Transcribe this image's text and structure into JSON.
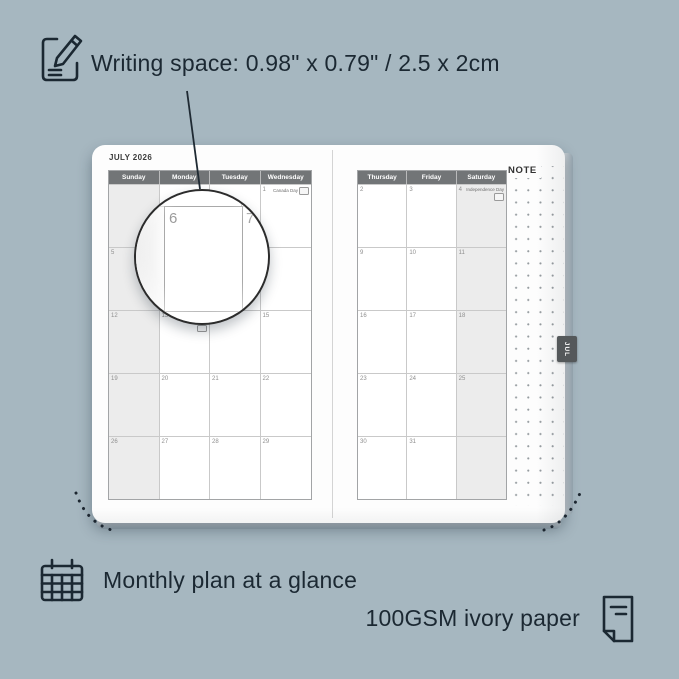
{
  "colors": {
    "background": "#a6b7c0",
    "annotation_text": "#1b2832",
    "calendar_header_bg": "#727577",
    "shaded_column_bg": "#ececec",
    "month_tab_bg": "#54585a",
    "page_bg": "#fdfdfd"
  },
  "annotations": {
    "writing_space": "Writing space: 0.98\" x 0.79\" / 2.5 x 2cm",
    "monthly_plan": "Monthly plan at a glance",
    "paper": "100GSM ivory paper"
  },
  "planner": {
    "month_title": "JULY 2026",
    "tab_label": "JUL",
    "note_label": "NOTE",
    "left_page": {
      "day_headers": [
        "Sunday",
        "Monday",
        "Tuesday",
        "Wednesday"
      ],
      "shaded_column": 0,
      "weeks": [
        [
          {
            "date": ""
          },
          {
            "date": ""
          },
          {
            "date": ""
          },
          {
            "date": "1",
            "holiday": "Canada Day",
            "badge": true
          }
        ],
        [
          {
            "date": "5"
          },
          {
            "date": "6"
          },
          {
            "date": "7"
          },
          {
            "date": "8"
          }
        ],
        [
          {
            "date": "12"
          },
          {
            "date": "13",
            "holiday": "Battle of the Boyne",
            "badge": true
          },
          {
            "date": "14"
          },
          {
            "date": "15"
          }
        ],
        [
          {
            "date": "19"
          },
          {
            "date": "20"
          },
          {
            "date": "21"
          },
          {
            "date": "22"
          }
        ],
        [
          {
            "date": "26"
          },
          {
            "date": "27"
          },
          {
            "date": "28"
          },
          {
            "date": "29"
          }
        ]
      ]
    },
    "right_page": {
      "day_headers": [
        "Thursday",
        "Friday",
        "Saturday"
      ],
      "shaded_column": 2,
      "weeks": [
        [
          {
            "date": "2"
          },
          {
            "date": "3"
          },
          {
            "date": "4",
            "holiday": "Independence Day",
            "badge": true
          }
        ],
        [
          {
            "date": "9"
          },
          {
            "date": "10"
          },
          {
            "date": "11"
          }
        ],
        [
          {
            "date": "16"
          },
          {
            "date": "17"
          },
          {
            "date": "18"
          }
        ],
        [
          {
            "date": "23"
          },
          {
            "date": "24"
          },
          {
            "date": "25"
          }
        ],
        [
          {
            "date": "30"
          },
          {
            "date": "31"
          },
          {
            "date": ""
          }
        ]
      ]
    },
    "loupe": {
      "dates": [
        "6",
        "7"
      ]
    }
  }
}
